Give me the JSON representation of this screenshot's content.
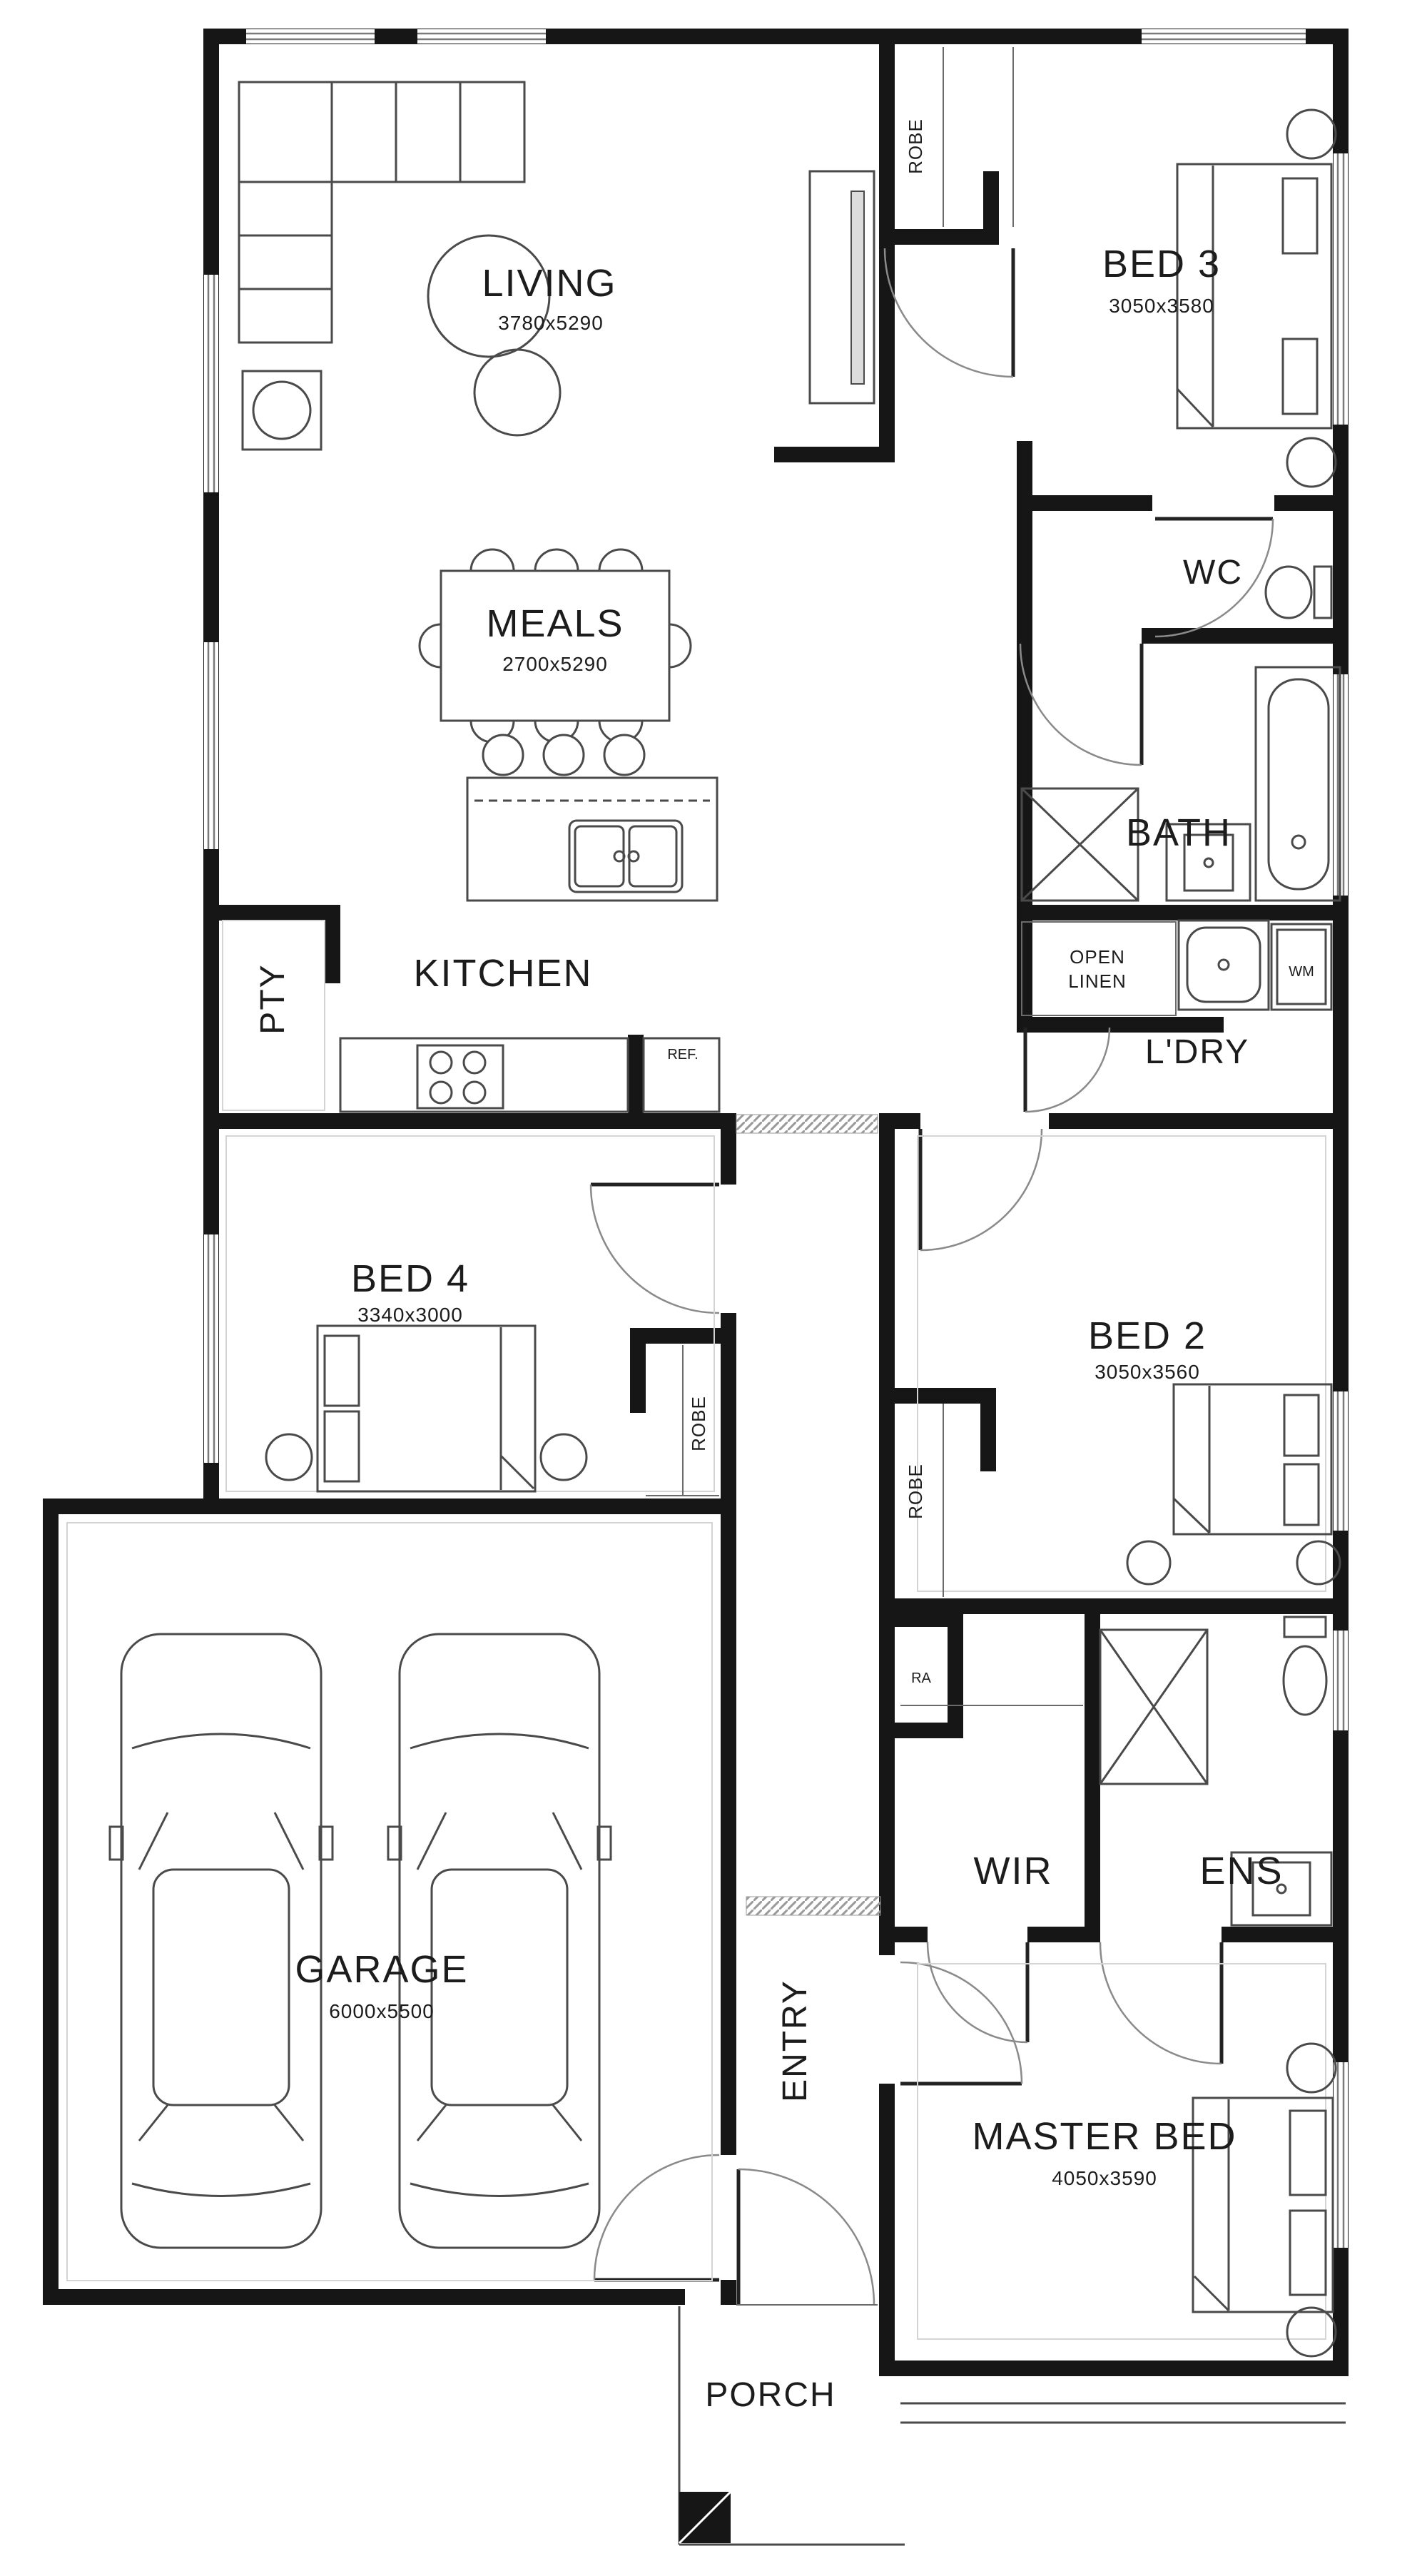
{
  "plan": {
    "rooms": {
      "living": {
        "label": "LIVING",
        "dims": "3780x5290"
      },
      "meals": {
        "label": "MEALS",
        "dims": "2700x5290"
      },
      "kitchen": {
        "label": "KITCHEN"
      },
      "pantry": {
        "label": "PTY"
      },
      "bed3": {
        "label": "BED 3",
        "dims": "3050x3580"
      },
      "robe_bed3": {
        "label": "ROBE"
      },
      "wc": {
        "label": "WC"
      },
      "bath": {
        "label": "BATH"
      },
      "open_linen": {
        "line1": "OPEN",
        "line2": "LINEN"
      },
      "laundry": {
        "label": "L'DRY"
      },
      "bed4": {
        "label": "BED 4",
        "dims": "3340x3000"
      },
      "robe_bed4": {
        "label": "ROBE"
      },
      "bed2": {
        "label": "BED 2",
        "dims": "3050x3560"
      },
      "robe_bed2": {
        "label": "ROBE"
      },
      "ra": {
        "label": "RA"
      },
      "wir": {
        "label": "WIR"
      },
      "ens": {
        "label": "ENS"
      },
      "garage": {
        "label": "GARAGE",
        "dims": "6000x5500"
      },
      "entry": {
        "label": "ENTRY"
      },
      "master": {
        "label": "MASTER BED",
        "dims": "4050x3590"
      },
      "porch": {
        "label": "PORCH"
      }
    },
    "appliances": {
      "wm": "WM",
      "ref": "REF."
    },
    "colors": {
      "wall": "#161616",
      "fixture_line": "#4a4a4a",
      "door_arc": "#8a8a8a",
      "text": "#1c1c1c"
    }
  }
}
